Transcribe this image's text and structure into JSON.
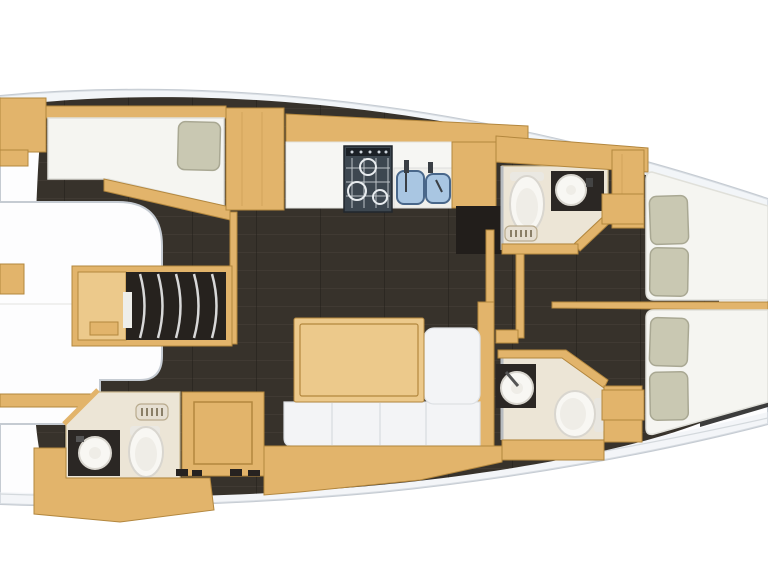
{
  "image": {
    "kind": "yacht-interior-floorplan-top-view",
    "orientation": "bow-left-stern-right"
  },
  "palette": {
    "hullFill": "#fdfdfe",
    "hullEdge": "#c5cbd2",
    "hullEdge2": "#d4d9dd",
    "deckBand": "#e9eef2",
    "floor": "#37322b",
    "plankLight": "#4a443b",
    "plankDark": "#221e19",
    "wood": "#e2b46b",
    "woodLight": "#ecc98b",
    "woodEdge": "#b3873e",
    "mattress": "#f5f5f1",
    "mattressEdge": "#e0e0da",
    "pillow": "#c9c8b2",
    "pillowEdge": "#a9a893",
    "headFloor": "#ece5d6",
    "headFloorEdge": "#cbb98f",
    "darkCounter": "#2b2724",
    "fixture": "#f8f7f3",
    "fixtureEdge": "#d9d6cf",
    "fixtureInner": "#efede7",
    "metal": "#8e9296",
    "trimDark": "#3c3c3c",
    "settee": "#f3f4f6",
    "setteeEdge": "#dde0e4",
    "wallGrey": "#b8bcc0",
    "hangerLine": "#d8d8d8",
    "ventFill": "#e6dfd2",
    "ventEdge": "#b9ab8e",
    "ventBar": "#8a7f68",
    "stoveDark": "#3d4750",
    "sinkBlue": "#a9c6e2",
    "sinkEdge": "#49678a"
  },
  "fixtures": [
    "forward-berth",
    "berth-pillow",
    "wardrobe-hangers",
    "forward-head-sink",
    "forward-head-toilet",
    "vent-grate",
    "galley-stove",
    "galley-double-sink",
    "salon-table",
    "salon-settee",
    "aft-head-starboard-toilet",
    "aft-head-starboard-sink",
    "aft-head-port-sink",
    "aft-head-port-toilet",
    "aft-berth-starboard",
    "aft-berth-port"
  ]
}
